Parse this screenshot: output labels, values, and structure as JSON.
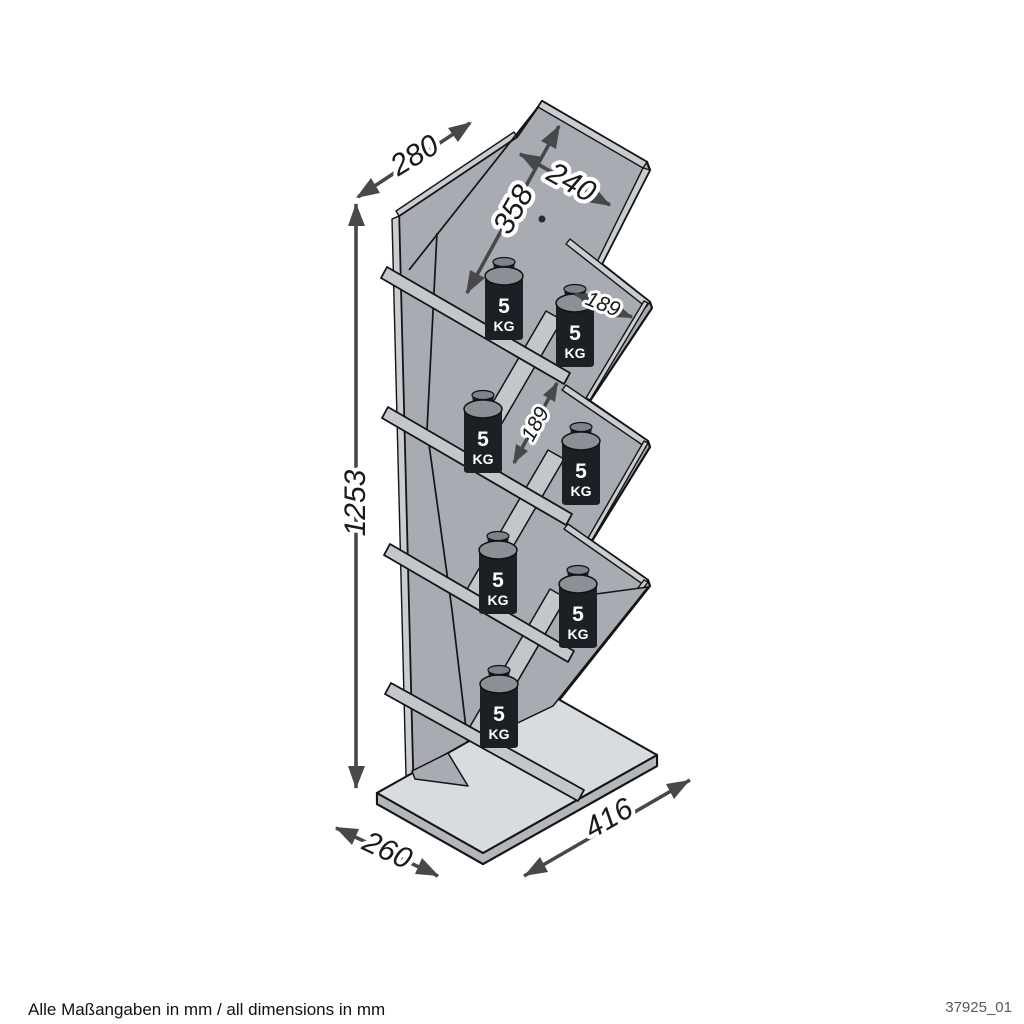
{
  "drawing": {
    "title_code": "37925_01",
    "footer_note": "Alle Maßangaben in mm / all dimensions in mm",
    "dimensions": {
      "top_depth": "280",
      "top_shelf_width": "240",
      "top_shelf_length": "358",
      "compartment_width": "189",
      "compartment_gap": "189",
      "total_height": "1253",
      "base_depth": "260",
      "base_width": "416"
    },
    "load_badge": {
      "value": "5",
      "unit": "KG",
      "count": 7
    },
    "colors": {
      "panel_gray": "#a7acb3",
      "edge_light": "#c9ccd0",
      "base_top": "#d9dcdf",
      "outline": "#141414",
      "arrow": "#48484b",
      "weight_body": "#1c1f23"
    }
  }
}
